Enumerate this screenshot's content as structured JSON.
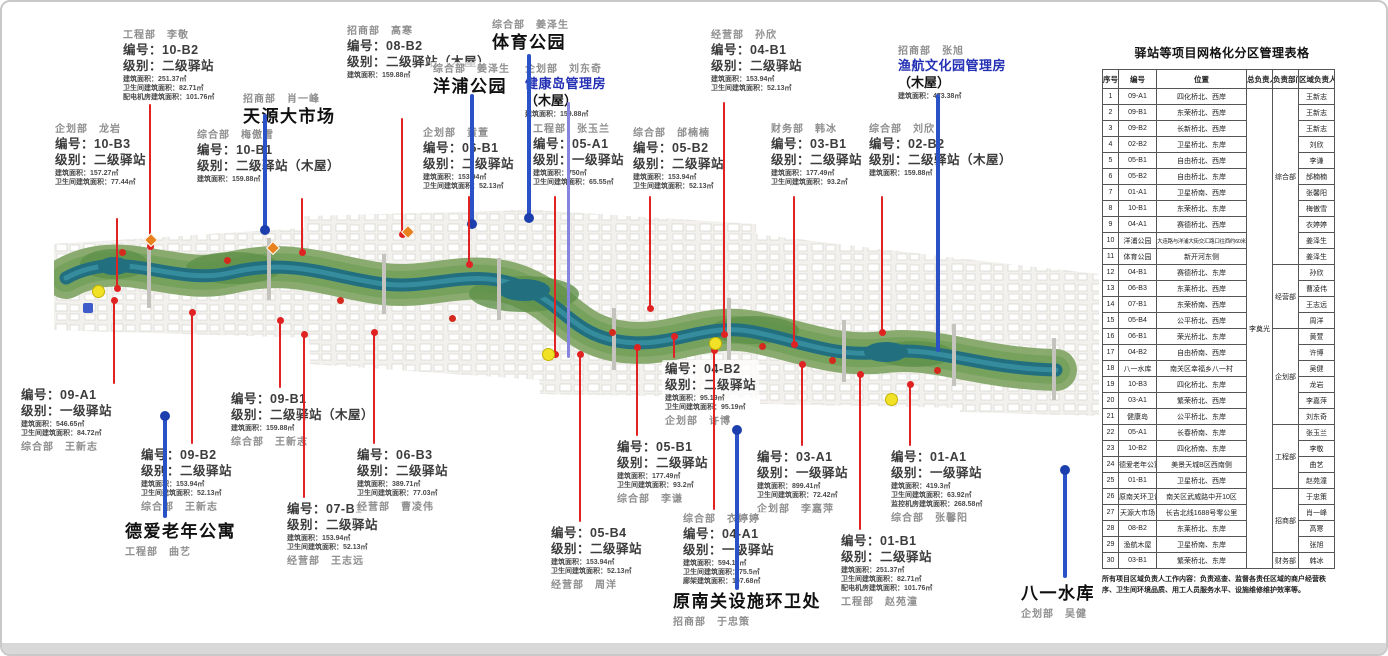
{
  "table": {
    "title": "驿站等项目网格化分区管理表格",
    "headers": [
      "序号",
      "编号",
      "位置",
      "总负责人",
      "负责部门",
      "区域负责人"
    ],
    "chief": "李奠光",
    "dept_groups": [
      {
        "label": "综合部",
        "start": 1,
        "span": 11
      },
      {
        "label": "经营部",
        "start": 12,
        "span": 4
      },
      {
        "label": "企划部",
        "start": 16,
        "span": 6
      },
      {
        "label": "工程部",
        "start": 22,
        "span": 4
      },
      {
        "label": "招商部",
        "start": 26,
        "span": 4
      },
      {
        "label": "财务部",
        "start": 30,
        "span": 1
      }
    ],
    "rows": [
      {
        "no": "1",
        "code": "09-A1",
        "loc": "四化桥北、西岸",
        "person": "王新志"
      },
      {
        "no": "2",
        "code": "09-B1",
        "loc": "东荣桥北、西岸",
        "person": "王新志"
      },
      {
        "no": "3",
        "code": "09-B2",
        "loc": "长新桥北、西岸",
        "person": "王新志"
      },
      {
        "no": "4",
        "code": "02-B2",
        "loc": "卫星桥北、东岸",
        "person": "刘欣"
      },
      {
        "no": "5",
        "code": "05-B1",
        "loc": "自由桥北、西岸",
        "person": "李谦"
      },
      {
        "no": "6",
        "code": "05-B2",
        "loc": "自由桥北、东岸",
        "person": "邰楠楠"
      },
      {
        "no": "7",
        "code": "01-A1",
        "loc": "卫星桥南、西岸",
        "person": "张馨阳"
      },
      {
        "no": "8",
        "code": "10-B1",
        "loc": "东荣桥北、东岸",
        "person": "梅傲雪"
      },
      {
        "no": "9",
        "code": "04-A1",
        "loc": "赛德桥北、西岸",
        "person": "衣婷婷"
      },
      {
        "no": "10",
        "code": "洋浦公园",
        "loc": "大连路与洋浦大街交汇路口往西约60米",
        "person": "姜泽生"
      },
      {
        "no": "11",
        "code": "体育公园",
        "loc": "新开河东侧",
        "person": "姜泽生"
      },
      {
        "no": "12",
        "code": "04-B1",
        "loc": "赛德桥北、东岸",
        "person": "孙欣"
      },
      {
        "no": "13",
        "code": "06-B3",
        "loc": "东莱桥北、西岸",
        "person": "曹凌伟"
      },
      {
        "no": "14",
        "code": "07-B1",
        "loc": "东荣桥南、西岸",
        "person": "王志远"
      },
      {
        "no": "15",
        "code": "05-B4",
        "loc": "公平桥北、西岸",
        "person": "周洋"
      },
      {
        "no": "16",
        "code": "06-B1",
        "loc": "荣光桥北、东岸",
        "person": "黄萱"
      },
      {
        "no": "17",
        "code": "04-B2",
        "loc": "自由桥南、西岸",
        "person": "许博"
      },
      {
        "no": "18",
        "code": "八一水库",
        "loc": "南关区幸福乡八一村",
        "person": "吴健"
      },
      {
        "no": "19",
        "code": "10-B3",
        "loc": "四化桥北、东岸",
        "person": "龙岩"
      },
      {
        "no": "20",
        "code": "03-A1",
        "loc": "繁荣桥北、西岸",
        "person": "李嘉萍"
      },
      {
        "no": "21",
        "code": "健康岛",
        "loc": "公平桥北、东岸",
        "person": "刘东奇"
      },
      {
        "no": "22",
        "code": "05-A1",
        "loc": "长春桥南、东岸",
        "person": "张玉兰"
      },
      {
        "no": "23",
        "code": "10-B2",
        "loc": "四化桥南、东岸",
        "person": "李敬"
      },
      {
        "no": "24",
        "code": "德爱老年公寓",
        "loc": "美景天城B区西南侧",
        "person": "曲艺"
      },
      {
        "no": "25",
        "code": "01-B1",
        "loc": "卫星桥北、西岸",
        "person": "赵苑潼"
      },
      {
        "no": "26",
        "code": "原南关环卫设施处",
        "loc": "南关区武威路中开10区",
        "person": "于忠策"
      },
      {
        "no": "27",
        "code": "天源大市场",
        "loc": "长吉北线1688号零公里",
        "person": "肖一峰"
      },
      {
        "no": "28",
        "code": "08-B2",
        "loc": "东莱桥北、东岸",
        "person": "高寒"
      },
      {
        "no": "29",
        "code": "渔航木屋",
        "loc": "卫星桥南、东岸",
        "person": "张旭"
      },
      {
        "no": "30",
        "code": "03-B1",
        "loc": "繁荣桥北、东岸",
        "person": "韩冰"
      }
    ],
    "footnote": "所有项目区域负责人工作内容：负责巡查、监督各责任区域的商户经营秩序、卫生间环境品质、用工人员服务水平、设施维修维护效率等。"
  },
  "callouts": [
    {
      "id": "10-B2",
      "x": 118,
      "y": 26,
      "dept": "工程部　李敬",
      "code": "编号：10-B2",
      "level": "级别：二级驿站",
      "metrics": [
        "建筑面积：251.37㎡",
        "卫生间建筑面积：82.71㎡",
        "配电机房建筑面积：101.76㎡"
      ]
    },
    {
      "id": "tianyuan",
      "x": 238,
      "y": 90,
      "dept": "招商部　肖一峰",
      "title": "天源大市场"
    },
    {
      "id": "08-B2",
      "x": 342,
      "y": 22,
      "dept": "招商部　高寒",
      "code": "编号：08-B2",
      "level": "级别：二级驿站（木屋）",
      "metrics": [
        "建筑面积：159.88㎡"
      ]
    },
    {
      "id": "tiyu",
      "x": 487,
      "y": 16,
      "dept": "综合部　姜泽生",
      "title": "体育公园"
    },
    {
      "id": "yangpu",
      "x": 428,
      "y": 60,
      "dept": "综合部　姜泽生",
      "title": "洋浦公园"
    },
    {
      "id": "jiankang",
      "x": 520,
      "y": 60,
      "dept": "企划部　刘东奇",
      "title_blue": "健康岛管理房",
      "title_suffix": "（木屋）",
      "metrics": [
        "建筑面积：159.88㎡"
      ]
    },
    {
      "id": "04-B1",
      "x": 706,
      "y": 26,
      "dept": "经营部　孙欣",
      "code": "编号：04-B1",
      "level": "级别：二级驿站",
      "metrics": [
        "建筑面积：153.94㎡",
        "卫生间建筑面积：52.13㎡"
      ]
    },
    {
      "id": "yuhang",
      "x": 893,
      "y": 42,
      "dept": "招商部　张旭",
      "title_blue": "渔航文化园管理房",
      "title_suffix": "（木屋）",
      "metrics": [
        "建筑面积：473.38㎡"
      ]
    },
    {
      "id": "10-B3",
      "x": 50,
      "y": 120,
      "dept": "企划部　龙岩",
      "code": "编号：10-B3",
      "level": "级别：二级驿站",
      "metrics": [
        "建筑面积：157.27㎡",
        "卫生间建筑面积：77.44㎡"
      ]
    },
    {
      "id": "10-B1",
      "x": 192,
      "y": 126,
      "dept": "综合部　梅傲雪",
      "code": "编号：10-B1",
      "level": "级别：二级驿站（木屋）",
      "metrics": [
        "建筑面积：159.88㎡"
      ]
    },
    {
      "id": "06-B1",
      "x": 418,
      "y": 124,
      "dept": "企划部　黄萱",
      "code": "编号：06-B1",
      "level": "级别：二级驿站",
      "metrics": [
        "建筑面积：153.94㎡",
        "卫生间建筑面积：52.13㎡"
      ]
    },
    {
      "id": "05-A1",
      "x": 528,
      "y": 120,
      "dept": "工程部　张玉兰",
      "code": "编号：05-A1",
      "level": "级别：一级驿站",
      "metrics": [
        "建筑面积：750㎡",
        "卫生间建筑面积：65.55㎡"
      ]
    },
    {
      "id": "05-B2",
      "x": 628,
      "y": 124,
      "dept": "综合部　邰楠楠",
      "code": "编号：05-B2",
      "level": "级别：二级驿站",
      "metrics": [
        "建筑面积：153.94㎡",
        "卫生间建筑面积：52.13㎡"
      ]
    },
    {
      "id": "03-B1",
      "x": 766,
      "y": 120,
      "dept": "财务部　韩冰",
      "code": "编号：03-B1",
      "level": "级别：二级驿站",
      "metrics": [
        "建筑面积：177.49㎡",
        "卫生间建筑面积：93.2㎡"
      ]
    },
    {
      "id": "02-B2",
      "x": 864,
      "y": 120,
      "dept": "综合部　刘欣",
      "code": "编号：02-B2",
      "level": "级别：二级驿站（木屋）",
      "metrics": [
        "建筑面积：159.88㎡"
      ]
    },
    {
      "id": "09-A1",
      "x": 16,
      "y": 384,
      "code": "编号：09-A1",
      "level": "级别：一级驿站",
      "metrics": [
        "建筑面积：546.65㎡",
        "卫生间建筑面积：84.72㎡"
      ],
      "dept_below": "综合部　王新志"
    },
    {
      "id": "09-B2",
      "x": 136,
      "y": 444,
      "code": "编号：09-B2",
      "level": "级别：二级驿站",
      "metrics": [
        "建筑面积：153.94㎡",
        "卫生间建筑面积：52.13㎡"
      ],
      "dept_below": "综合部　王新志"
    },
    {
      "id": "deai",
      "x": 120,
      "y": 518,
      "title": "德爱老年公寓",
      "dept_below": "工程部　曲艺"
    },
    {
      "id": "09-B1",
      "x": 226,
      "y": 388,
      "code": "编号：09-B1",
      "level": "级别：二级驿站（木屋）",
      "metrics": [
        "建筑面积：159.88㎡"
      ],
      "dept_below": "综合部　王新志"
    },
    {
      "id": "07-B1",
      "x": 282,
      "y": 498,
      "code": "编号：07-B1",
      "level": "级别：二级驿站",
      "metrics": [
        "建筑面积：153.94㎡",
        "卫生间建筑面积：52.13㎡"
      ],
      "dept_below": "经营部　王志远"
    },
    {
      "id": "06-B3",
      "x": 352,
      "y": 444,
      "code": "编号：06-B3",
      "level": "级别：二级驿站",
      "metrics": [
        "建筑面积：389.71㎡",
        "卫生间建筑面积：77.03㎡"
      ],
      "dept_below": "经营部　曹凌伟"
    },
    {
      "id": "05-B4",
      "x": 546,
      "y": 522,
      "code": "编号：05-B4",
      "level": "级别：二级驿站",
      "metrics": [
        "建筑面积：153.94㎡",
        "卫生间建筑面积：52.13㎡"
      ],
      "dept_below": "经营部　周洋"
    },
    {
      "id": "05-B1",
      "x": 612,
      "y": 436,
      "code": "编号：05-B1",
      "level": "级别：二级驿站",
      "metrics": [
        "建筑面积：177.49㎡",
        "卫生间建筑面积：93.2㎡"
      ],
      "dept_below": "综合部　李谦"
    },
    {
      "id": "04-B2",
      "x": 660,
      "y": 358,
      "code": "编号：04-B2",
      "level": "级别：二级驿站",
      "metrics": [
        "建筑面积：95.19㎡",
        "卫生间建筑面积：95.19㎡"
      ],
      "dept_below": "企划部　许博"
    },
    {
      "id": "03-A1",
      "x": 752,
      "y": 446,
      "code": "编号：03-A1",
      "level": "级别：一级驿站",
      "metrics": [
        "建筑面积：899.41㎡",
        "卫生间建筑面积：72.42㎡"
      ],
      "dept_below": "企划部　李嘉萍"
    },
    {
      "id": "04-A1",
      "x": 678,
      "y": 510,
      "dept": "综合部　衣婷婷",
      "code": "编号：04-A1",
      "level": "级别：一级驿站",
      "metrics": [
        "建筑面积：594.16㎡",
        "卫生间建筑面积：75.5㎡",
        "廊架建筑面积：107.68㎡"
      ]
    },
    {
      "id": "yuannanguan",
      "x": 668,
      "y": 588,
      "title": "原南关设施环卫处",
      "dept_below": "招商部　于忠策"
    },
    {
      "id": "01-B1",
      "x": 836,
      "y": 530,
      "code": "编号：01-B1",
      "level": "级别：二级驿站",
      "metrics": [
        "建筑面积：251.37㎡",
        "卫生间建筑面积：82.71㎡",
        "配电机房建筑面积：101.76㎡"
      ],
      "dept_below": "工程部　赵苑潼"
    },
    {
      "id": "01-A1",
      "x": 886,
      "y": 446,
      "code": "编号：01-A1",
      "level": "级别：一级驿站",
      "metrics": [
        "建筑面积：419.3㎡",
        "卫生间建筑面积：63.92㎡",
        "监控机房建筑面积：268.58㎡"
      ],
      "dept_below": "综合部　张馨阳"
    },
    {
      "id": "bayi",
      "x": 1016,
      "y": 580,
      "title": "八一水库",
      "dept_below": "企划部　吴健"
    }
  ],
  "lines": [
    {
      "x": 263,
      "y1": 112,
      "y2": 228,
      "color": "blue",
      "dot": "bottom"
    },
    {
      "x": 470,
      "y1": 92,
      "y2": 222,
      "color": "blue",
      "dot": "bottom"
    },
    {
      "x": 527,
      "y1": 52,
      "y2": 216,
      "color": "blue",
      "dot": "bottom"
    },
    {
      "x": 566,
      "y1": 100,
      "y2": 356,
      "color": "purple",
      "dot": "none"
    },
    {
      "x": 936,
      "y1": 92,
      "y2": 350,
      "color": "blue",
      "dot": "none"
    },
    {
      "x": 163,
      "y1": 414,
      "y2": 516,
      "color": "blue",
      "dot": "top"
    },
    {
      "x": 735,
      "y1": 428,
      "y2": 588,
      "color": "blue",
      "dot": "top"
    },
    {
      "x": 1063,
      "y1": 468,
      "y2": 576,
      "color": "blue",
      "dot": "top"
    },
    {
      "x": 148,
      "y1": 102,
      "y2": 244,
      "color": "red",
      "dot": "bottom"
    },
    {
      "x": 115,
      "y1": 216,
      "y2": 286,
      "color": "red",
      "dot": "bottom"
    },
    {
      "x": 300,
      "y1": 196,
      "y2": 250,
      "color": "red",
      "dot": "bottom"
    },
    {
      "x": 400,
      "y1": 116,
      "y2": 232,
      "color": "red",
      "dot": "bottom"
    },
    {
      "x": 467,
      "y1": 194,
      "y2": 262,
      "color": "red",
      "dot": "bottom"
    },
    {
      "x": 553,
      "y1": 194,
      "y2": 352,
      "color": "red",
      "dot": "bottom"
    },
    {
      "x": 648,
      "y1": 194,
      "y2": 306,
      "color": "red",
      "dot": "bottom"
    },
    {
      "x": 722,
      "y1": 100,
      "y2": 332,
      "color": "red",
      "dot": "bottom"
    },
    {
      "x": 792,
      "y1": 194,
      "y2": 342,
      "color": "red",
      "dot": "bottom"
    },
    {
      "x": 880,
      "y1": 194,
      "y2": 330,
      "color": "red",
      "dot": "bottom"
    },
    {
      "x": 112,
      "y1": 298,
      "y2": 382,
      "color": "red",
      "dot": "top"
    },
    {
      "x": 190,
      "y1": 310,
      "y2": 442,
      "color": "red",
      "dot": "top"
    },
    {
      "x": 278,
      "y1": 318,
      "y2": 386,
      "color": "red",
      "dot": "top"
    },
    {
      "x": 302,
      "y1": 332,
      "y2": 496,
      "color": "red",
      "dot": "top"
    },
    {
      "x": 372,
      "y1": 330,
      "y2": 442,
      "color": "red",
      "dot": "top"
    },
    {
      "x": 578,
      "y1": 352,
      "y2": 520,
      "color": "red",
      "dot": "top"
    },
    {
      "x": 635,
      "y1": 345,
      "y2": 434,
      "color": "red",
      "dot": "top"
    },
    {
      "x": 672,
      "y1": 334,
      "y2": 356,
      "color": "red",
      "dot": "top"
    },
    {
      "x": 800,
      "y1": 362,
      "y2": 444,
      "color": "red",
      "dot": "top"
    },
    {
      "x": 712,
      "y1": 348,
      "y2": 508,
      "color": "red",
      "dot": "top"
    },
    {
      "x": 858,
      "y1": 372,
      "y2": 528,
      "color": "red",
      "dot": "top"
    },
    {
      "x": 908,
      "y1": 382,
      "y2": 444,
      "color": "red",
      "dot": "top"
    }
  ],
  "markers": {
    "yellow": [
      [
        95,
        288
      ],
      [
        545,
        351
      ],
      [
        712,
        340
      ],
      [
        888,
        396
      ]
    ],
    "orange": [
      [
        148,
        237
      ],
      [
        270,
        245
      ],
      [
        405,
        229
      ]
    ],
    "red": [
      [
        120,
        250
      ],
      [
        225,
        258
      ],
      [
        338,
        298
      ],
      [
        450,
        316
      ],
      [
        610,
        330
      ],
      [
        760,
        344
      ],
      [
        830,
        358
      ],
      [
        935,
        368
      ]
    ],
    "blue_sq": [
      [
        86,
        306
      ]
    ]
  },
  "colors": {
    "red_line": "#e02222",
    "blue_line": "#2b51c7",
    "purple_line": "#8585dd",
    "blue_dot": "#1d3fae",
    "river": "#226f80",
    "greenway": "#84a768",
    "title_blue": "#2531b5"
  }
}
